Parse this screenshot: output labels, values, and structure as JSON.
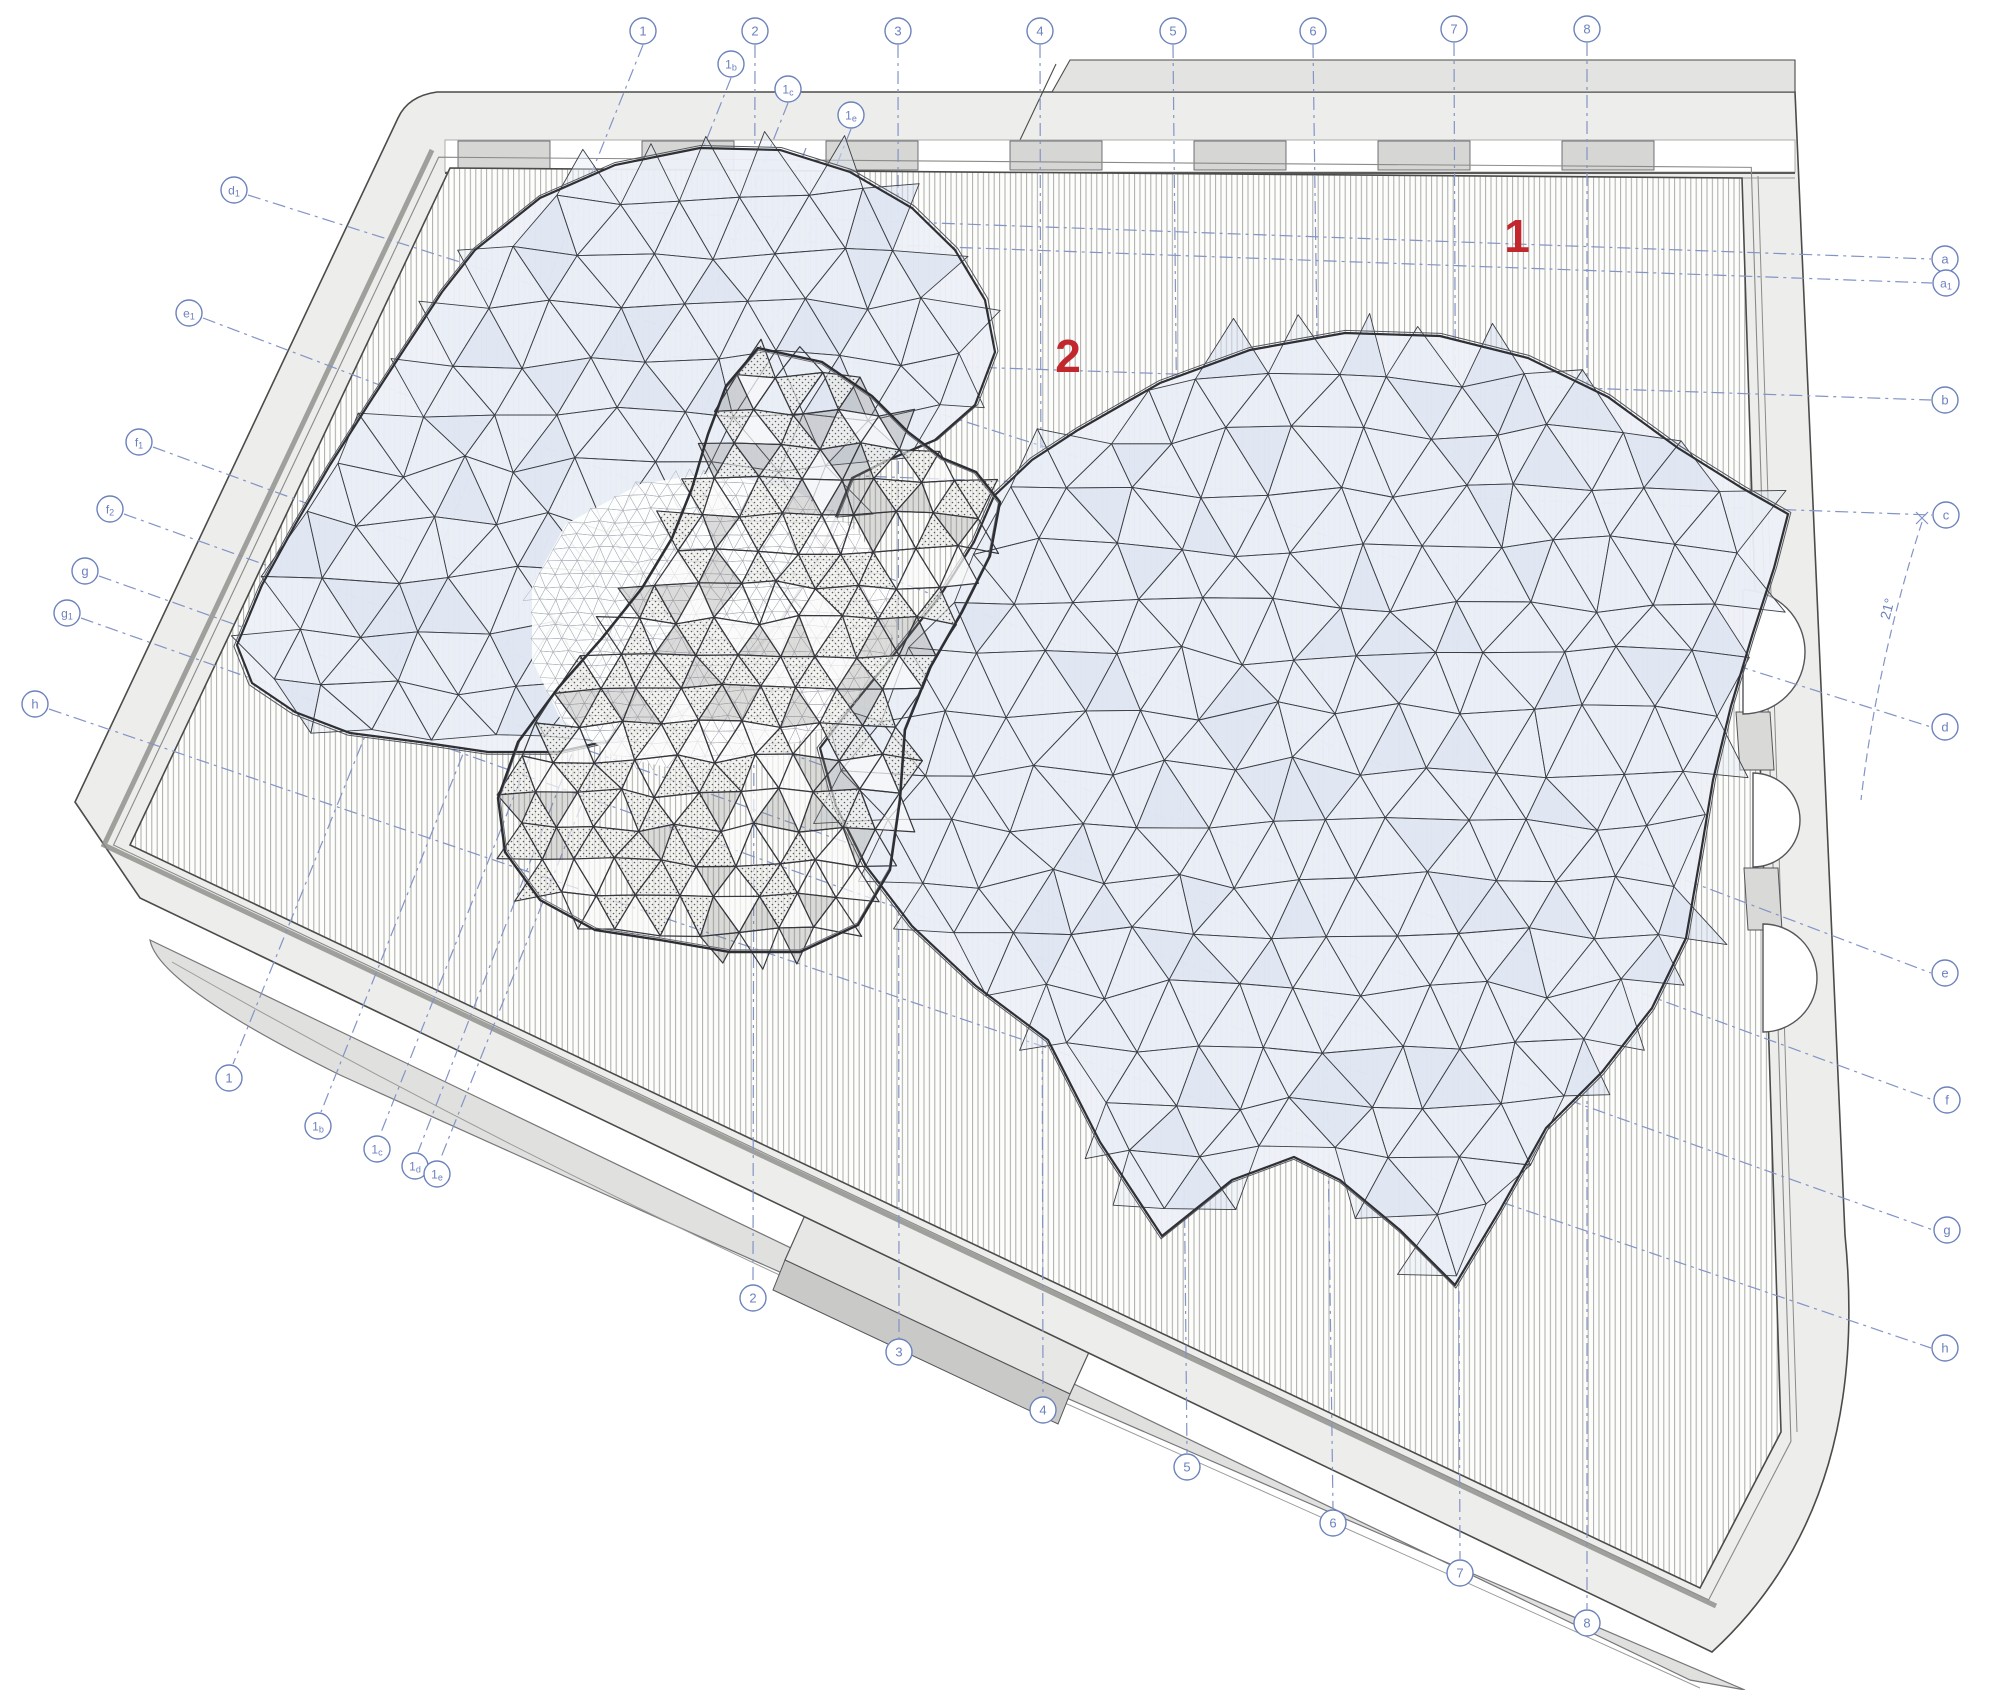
{
  "drawing": {
    "title": "roof plan – triangulated gridshell canopy over rectangular hall",
    "colors": {
      "grid_line": "#8394c6",
      "label": "#6c82bd",
      "red_mark": "#c1272d",
      "slab": "#ededeb",
      "slab_dark": "#e0e0de",
      "tab": "#e3e3e1",
      "panel": "#d6d6d4",
      "hatch_line": "#ababa8",
      "mesh_fill": "#edf0f7",
      "mesh_line": "#3c3e44",
      "frame_dark": "#4b4b49"
    },
    "red_marks": [
      {
        "text": "1",
        "x": 1517,
        "y": 252
      },
      {
        "text": "2",
        "x": 1068,
        "y": 372
      }
    ],
    "angle_annotation": {
      "text": "21°",
      "x": 1892,
      "y": 610,
      "rotation": -75
    },
    "grid_labels": {
      "top": [
        {
          "text": "1",
          "x": 643,
          "y": 31
        },
        {
          "text": "1b",
          "x": 731,
          "y": 64
        },
        {
          "text": "1c",
          "x": 788,
          "y": 89
        },
        {
          "text": "1e",
          "x": 851,
          "y": 115
        },
        {
          "text": "2",
          "x": 755,
          "y": 31
        },
        {
          "text": "3",
          "x": 898,
          "y": 31
        },
        {
          "text": "4",
          "x": 1040,
          "y": 31
        },
        {
          "text": "5",
          "x": 1173,
          "y": 31
        },
        {
          "text": "6",
          "x": 1313,
          "y": 31
        },
        {
          "text": "7",
          "x": 1454,
          "y": 29
        },
        {
          "text": "8",
          "x": 1587,
          "y": 29
        }
      ],
      "bottom": [
        {
          "text": "1",
          "x": 229,
          "y": 1078
        },
        {
          "text": "1b",
          "x": 318,
          "y": 1126
        },
        {
          "text": "1c",
          "x": 377,
          "y": 1149
        },
        {
          "text": "1d",
          "x": 415,
          "y": 1166
        },
        {
          "text": "1e",
          "x": 437,
          "y": 1174
        },
        {
          "text": "2",
          "x": 753,
          "y": 1298
        },
        {
          "text": "3",
          "x": 899,
          "y": 1352
        },
        {
          "text": "4",
          "x": 1043,
          "y": 1410
        },
        {
          "text": "5",
          "x": 1187,
          "y": 1467
        },
        {
          "text": "6",
          "x": 1333,
          "y": 1523
        },
        {
          "text": "7",
          "x": 1460,
          "y": 1573
        },
        {
          "text": "8",
          "x": 1587,
          "y": 1623
        }
      ],
      "left": [
        {
          "text": "d1",
          "x": 234,
          "y": 190
        },
        {
          "text": "e1",
          "x": 189,
          "y": 313
        },
        {
          "text": "f1",
          "x": 139,
          "y": 442
        },
        {
          "text": "f2",
          "x": 110,
          "y": 509
        },
        {
          "text": "g",
          "x": 85,
          "y": 571
        },
        {
          "text": "g1",
          "x": 67,
          "y": 613
        },
        {
          "text": "h",
          "x": 35,
          "y": 704
        }
      ],
      "right": [
        {
          "text": "a",
          "x": 1945,
          "y": 259
        },
        {
          "text": "a1",
          "x": 1946,
          "y": 283
        },
        {
          "text": "b",
          "x": 1945,
          "y": 400
        },
        {
          "text": "c",
          "x": 1946,
          "y": 515
        },
        {
          "text": "d",
          "x": 1945,
          "y": 727
        },
        {
          "text": "e",
          "x": 1945,
          "y": 973
        },
        {
          "text": "f",
          "x": 1947,
          "y": 1100
        },
        {
          "text": "g",
          "x": 1947,
          "y": 1230
        },
        {
          "text": "h",
          "x": 1945,
          "y": 1348
        }
      ]
    },
    "grid_lines": [
      {
        "name": "1",
        "x1": 643,
        "y1": 45,
        "x2": 233,
        "y2": 1064
      },
      {
        "name": "1b",
        "x1": 731,
        "y1": 78,
        "x2": 321,
        "y2": 1112
      },
      {
        "name": "1c",
        "x1": 788,
        "y1": 103,
        "x2": 380,
        "y2": 1135
      },
      {
        "name": "1d",
        "x1": 806,
        "y1": 148,
        "x2": 418,
        "y2": 1152
      },
      {
        "name": "1e",
        "x1": 851,
        "y1": 129,
        "x2": 440,
        "y2": 1160
      },
      {
        "name": "2",
        "x1": 755,
        "y1": 45,
        "x2": 753,
        "y2": 1284
      },
      {
        "name": "3",
        "x1": 898,
        "y1": 45,
        "x2": 899,
        "y2": 1338
      },
      {
        "name": "4",
        "x1": 1040,
        "y1": 45,
        "x2": 1043,
        "y2": 1396
      },
      {
        "name": "5",
        "x1": 1173,
        "y1": 45,
        "x2": 1187,
        "y2": 1453
      },
      {
        "name": "6",
        "x1": 1313,
        "y1": 45,
        "x2": 1333,
        "y2": 1509
      },
      {
        "name": "7",
        "x1": 1454,
        "y1": 43,
        "x2": 1460,
        "y2": 1559
      },
      {
        "name": "8",
        "x1": 1587,
        "y1": 43,
        "x2": 1587,
        "y2": 1609
      },
      {
        "name": "a",
        "x1": 630,
        "y1": 212,
        "x2": 1931,
        "y2": 259
      },
      {
        "name": "a1",
        "x1": 700,
        "y1": 238,
        "x2": 1932,
        "y2": 283
      },
      {
        "name": "b",
        "x1": 620,
        "y1": 355,
        "x2": 1931,
        "y2": 400
      },
      {
        "name": "c",
        "x1": 640,
        "y1": 468,
        "x2": 1932,
        "y2": 515
      },
      {
        "name": "d",
        "x1": 248,
        "y1": 195,
        "x2": 1931,
        "y2": 727
      },
      {
        "name": "e",
        "x1": 203,
        "y1": 318,
        "x2": 1931,
        "y2": 973
      },
      {
        "name": "f",
        "x1": 153,
        "y1": 447,
        "x2": 1933,
        "y2": 1100
      },
      {
        "name": "f2",
        "x1": 124,
        "y1": 514,
        "x2": 1530,
        "y2": 1020
      },
      {
        "name": "g",
        "x1": 99,
        "y1": 576,
        "x2": 1933,
        "y2": 1230
      },
      {
        "name": "g1",
        "x1": 81,
        "y1": 618,
        "x2": 1530,
        "y2": 1132
      },
      {
        "name": "h",
        "x1": 49,
        "y1": 709,
        "x2": 1931,
        "y2": 1348
      }
    ]
  }
}
